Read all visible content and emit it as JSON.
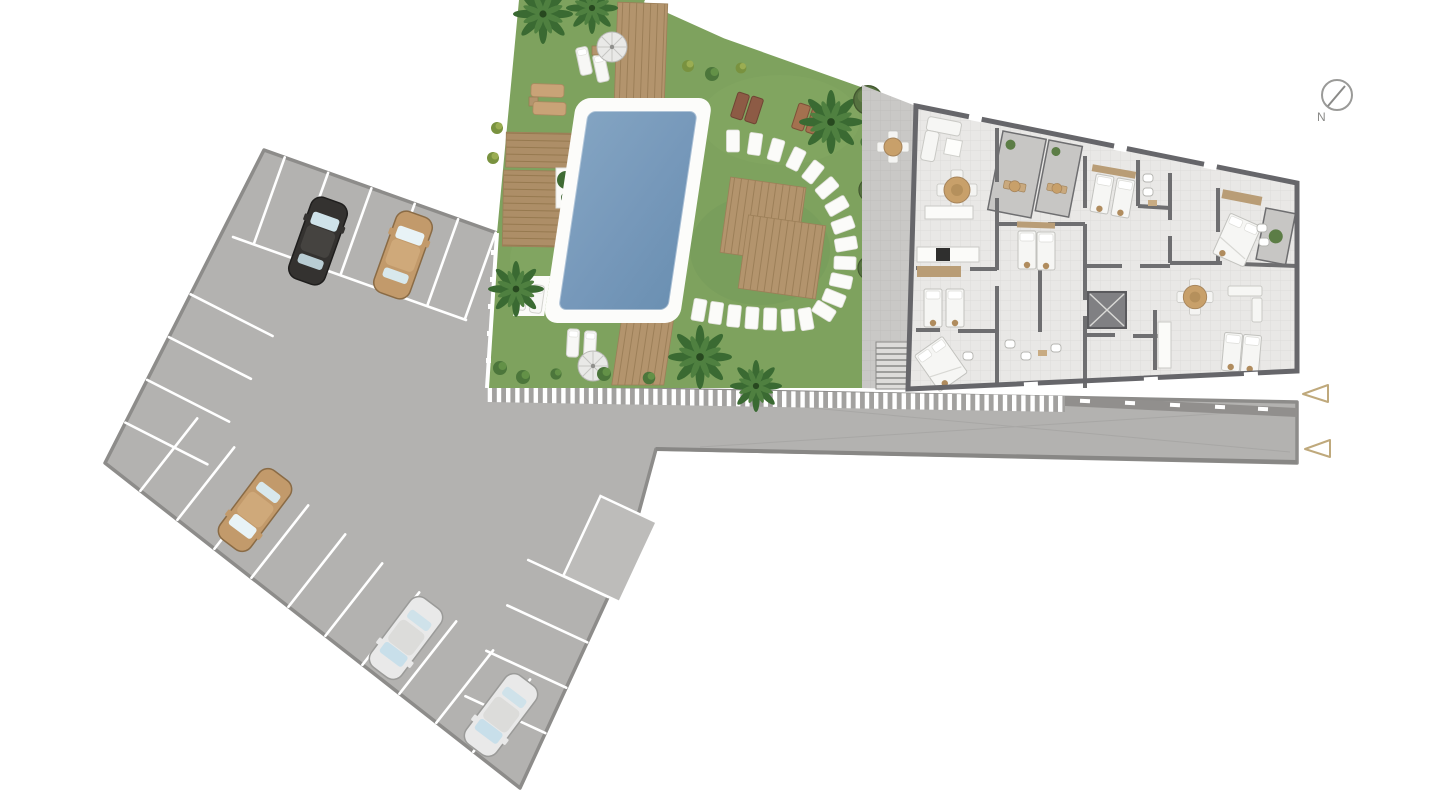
{
  "site_plan": {
    "compass": {
      "label": "N"
    },
    "entry_markers": {
      "count": 2,
      "direction": "left",
      "outline_color": "#bfa97c"
    },
    "areas": {
      "parking": {
        "surface_color": "#b3b2b0",
        "stall_line_color": "#ffffff",
        "stall_divider_lines": 24,
        "marked_reserved_stall": 1,
        "cars": [
          {
            "id": "car-1",
            "color_name": "black",
            "body_color": "#343230"
          },
          {
            "id": "car-2",
            "color_name": "tan",
            "body_color": "#c29a6b"
          },
          {
            "id": "car-3",
            "color_name": "tan",
            "body_color": "#c29a6b"
          },
          {
            "id": "car-4",
            "color_name": "white",
            "body_color": "#e9e9e9"
          },
          {
            "id": "car-5",
            "color_name": "white",
            "body_color": "#e9e9e9"
          }
        ]
      },
      "garden": {
        "grass_color": "#7ea25e",
        "deck_wood_color": "#b3946d",
        "pool": {
          "count": 1,
          "water_color": "#7c9fbe",
          "coping_color": "#fcfcfa"
        },
        "umbrella_count": 2,
        "palm_tree_count": 6,
        "hedge_tree_count": 3,
        "shrub_cluster_count": 10,
        "stepping_stone_count": 20,
        "sun_loungers": {
          "white": 6,
          "tan": 2,
          "brown": 4
        }
      },
      "building": {
        "floor_color": "#e9e8e6",
        "wall_color": "#66666a",
        "terrace_paving_color": "#c9c8c6",
        "stair_shaft": 1
      },
      "walkway": {
        "stripe_color": "#ffffff",
        "base_color": "#a2a19f"
      }
    }
  }
}
